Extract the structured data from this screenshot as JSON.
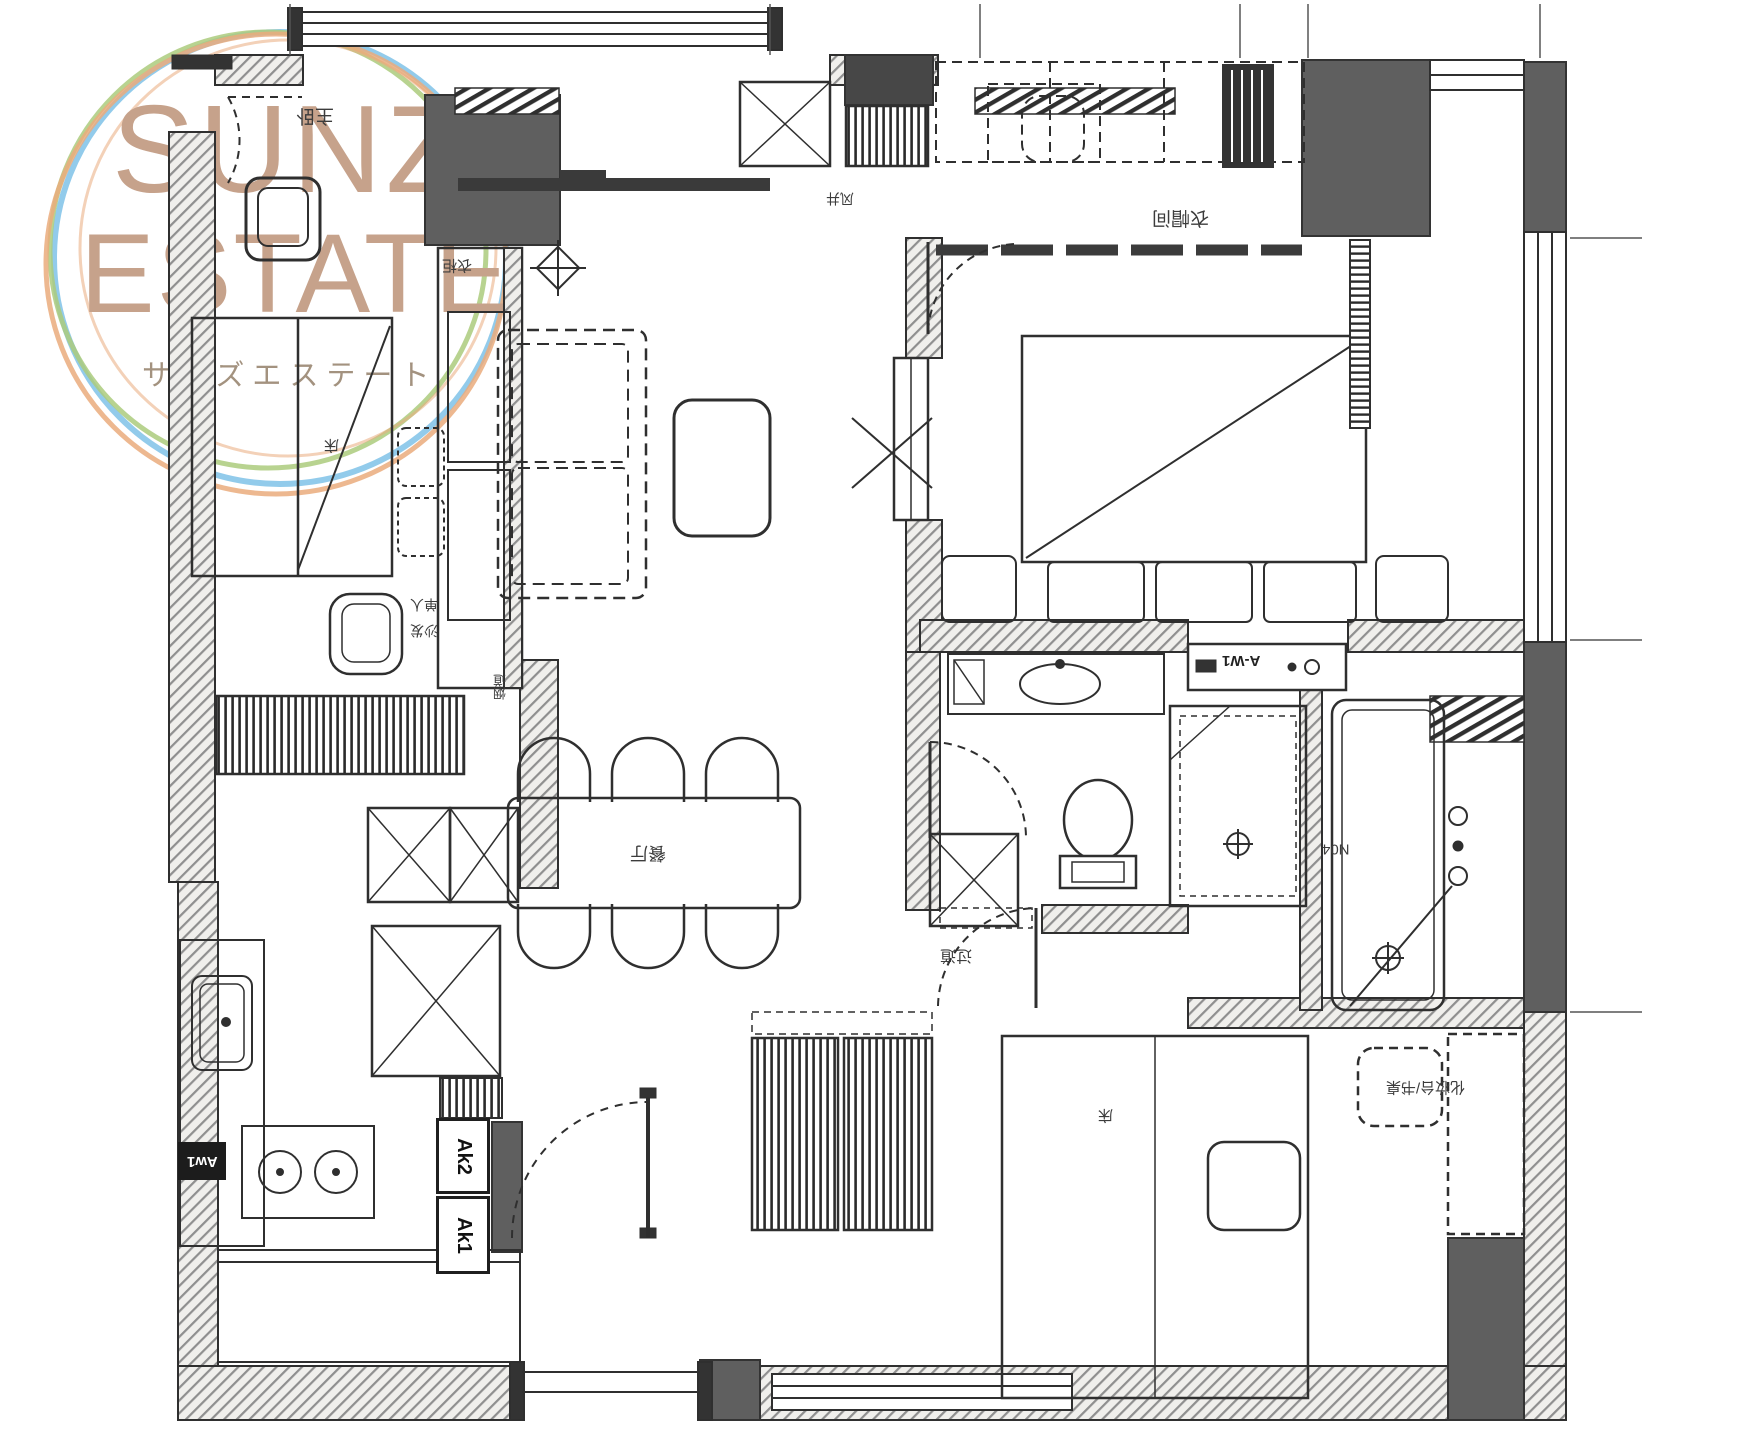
{
  "watermark": {
    "brand_line1": "SUNZ",
    "brand_line2": "ESTATE",
    "brand_kana": "サンズエステート"
  },
  "plan": {
    "type": "apartment-floor-plan",
    "label_orientation": "rotated-180",
    "room_labels": [
      {
        "id": "master-bedroom",
        "text": "主卧"
      },
      {
        "id": "master-bed",
        "text": "床"
      },
      {
        "id": "master-wardrobe",
        "text": "衣柜"
      },
      {
        "id": "armchair-line1",
        "text": "单人"
      },
      {
        "id": "armchair-line2",
        "text": "沙发"
      },
      {
        "id": "flue",
        "text": "烟道"
      },
      {
        "id": "vent-shaft",
        "text": "风井"
      },
      {
        "id": "walkin-closet",
        "text": "衣帽间"
      },
      {
        "id": "dining-room",
        "text": "餐厅"
      },
      {
        "id": "hallway",
        "text": "过道"
      },
      {
        "id": "second-bed",
        "text": "床"
      },
      {
        "id": "dresser-desk",
        "text": "化妆台/书桌"
      },
      {
        "id": "room-number",
        "text": "N04"
      }
    ],
    "equipment_labels": [
      {
        "id": "ak2",
        "text": "Ak2"
      },
      {
        "id": "ak1",
        "text": "Ak1"
      },
      {
        "id": "aw1",
        "text": "Aw1"
      },
      {
        "id": "a-w1",
        "text": "A-W1"
      }
    ],
    "colors": {
      "ink": "#2f2f2f",
      "column_fill": "#5f5f5f",
      "wall_hatch": "#8f8f8f",
      "watermark_text": "#c6a28b",
      "kana_text": "#a3927f",
      "ring_blue": "#86c5e9",
      "ring_green": "#abcb7d",
      "ring_orange": "#eaab7d"
    }
  }
}
